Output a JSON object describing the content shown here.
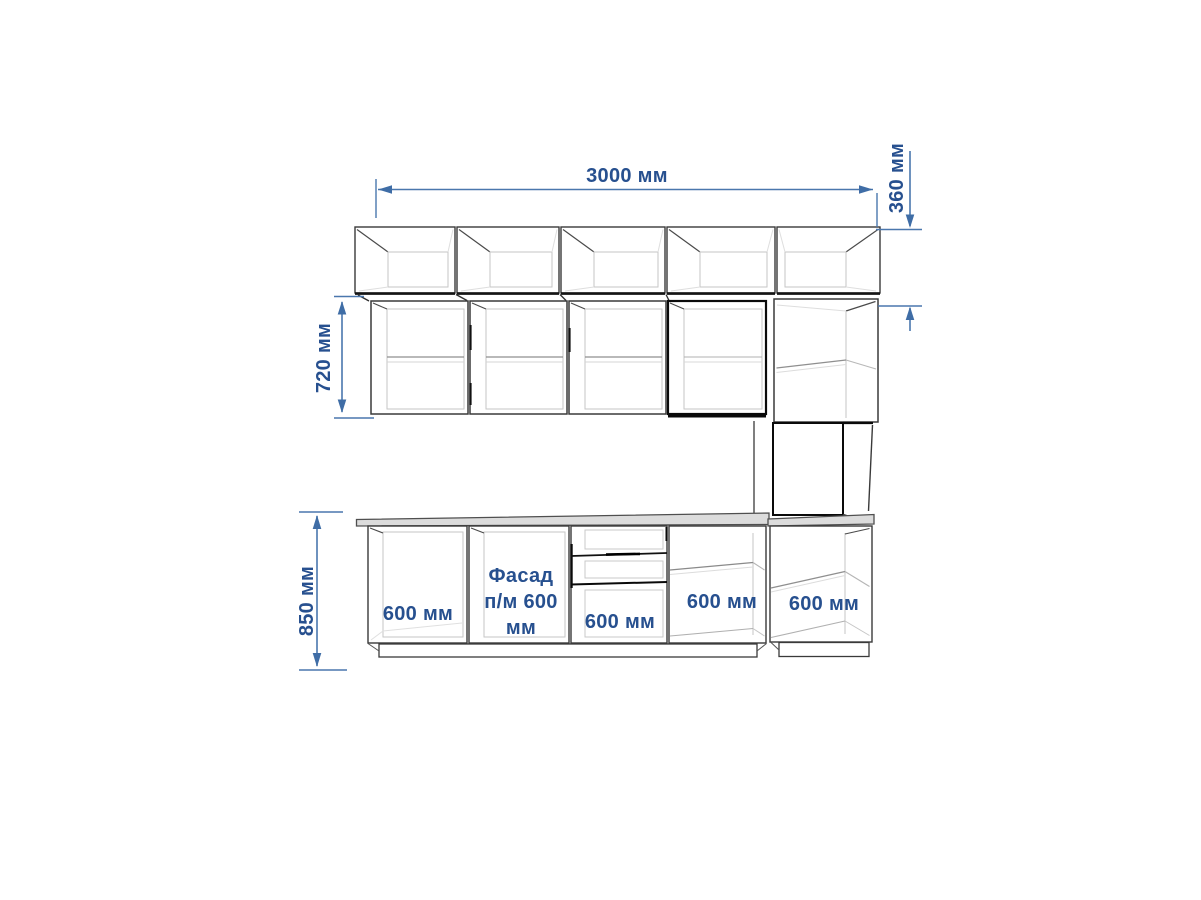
{
  "drawing_labels": {
    "total_width": "3000 мм",
    "top_row_height": "360 мм",
    "wall_row_height": "720 мм",
    "base_row_height": "850 мм",
    "base_cabinets": [
      "600 мм",
      "Фасад п/м 600 мм",
      "600 мм",
      "600 мм",
      "600 мм"
    ]
  },
  "colors": {
    "dimension_line": "#4a77ad",
    "dimension_text": "#27508f",
    "cabinet_outline": "#3a3a3a",
    "highlight_outline": "#0a0a0a",
    "countertop_fill": "#dcdcdc",
    "background": "#ffffff"
  }
}
